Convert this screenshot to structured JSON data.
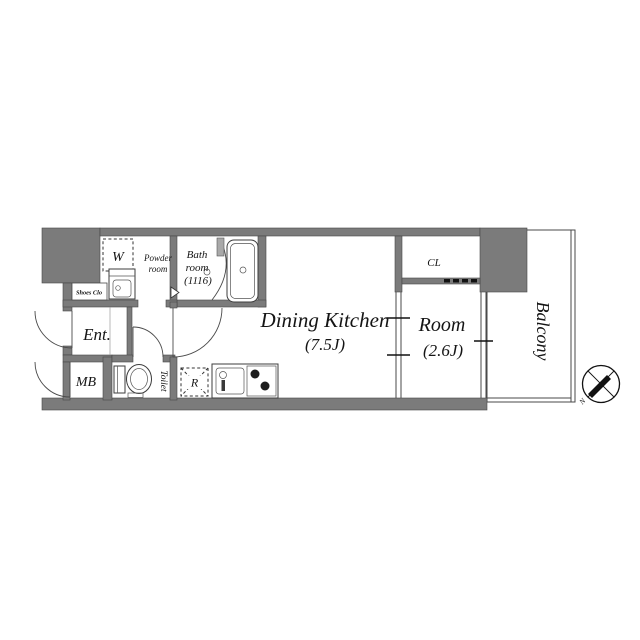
{
  "palette": {
    "wall_gray": "#7b7b7b",
    "wall_edge": "#474747",
    "line": "#4a4a4a",
    "text": "#151515",
    "background": "#ffffff"
  },
  "labels": {
    "dining_kitchen": "Dining Kitchen",
    "dining_kitchen_size": "(7.5J)",
    "room": "Room",
    "room_size": "(2.6J)",
    "balcony": "Balcony",
    "bath_line1": "Bath",
    "bath_line2": "room",
    "bath_line3": "(1116)",
    "powder_line1": "Powder",
    "powder_line2": "room",
    "entrance": "Ent.",
    "meter_box": "MB",
    "toilet": "Toilet",
    "closet": "CL",
    "shoes_closet": "Shoes Clo",
    "washer": "W",
    "refrigerator": "R",
    "compass_north": "N"
  }
}
